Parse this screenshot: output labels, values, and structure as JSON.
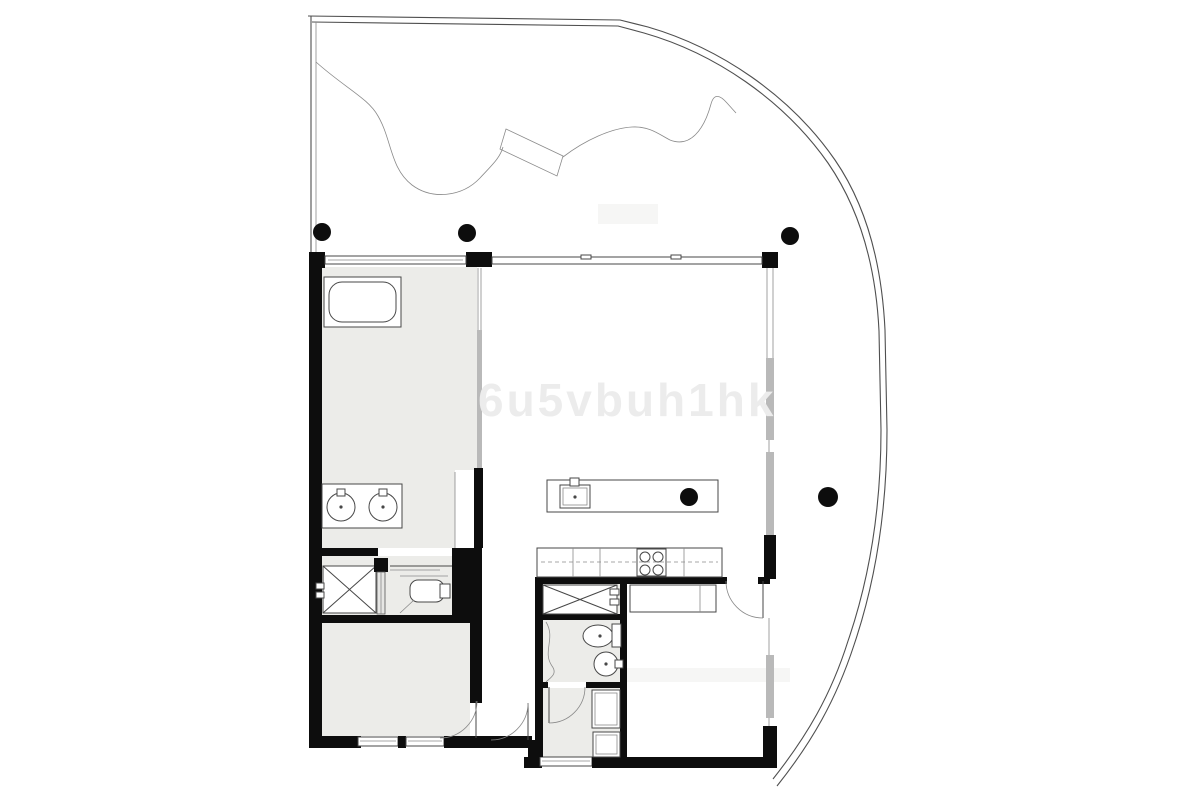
{
  "canvas": {
    "width": 1200,
    "height": 800
  },
  "palette": {
    "bg": "#ffffff",
    "wall": "#0d0d0d",
    "line": "#4f4f4f",
    "thin": "#8a8a8a",
    "floor": "#ecece9",
    "glazing": "#b9b9b9",
    "watermark": "#ececec",
    "smudge": "#f6f6f5"
  },
  "watermark": {
    "text": "6u5vbuh1hk"
  },
  "plan": {
    "type": "apartment-floor-plan-with-terrace",
    "rooms": [
      {
        "name": "terrace",
        "features": [
          "curved-perimeter",
          "garden-bed-line",
          "planter-walkway",
          "structural-columns"
        ]
      },
      {
        "name": "main-bathroom",
        "fixtures": [
          "bathtub",
          "double-vanity",
          "sink-basin",
          "sink-basin",
          "glass-partition"
        ]
      },
      {
        "name": "dressing-area",
        "fixtures": [
          "wardrobe",
          "sliding-door",
          "wc-pan"
        ]
      },
      {
        "name": "bedroom-1",
        "fixtures": [
          "door",
          "windows"
        ]
      },
      {
        "name": "entry-hall",
        "fixtures": [
          "door"
        ]
      },
      {
        "name": "living-dining",
        "fixtures": [
          "kitchen-island",
          "island-sink",
          "column"
        ]
      },
      {
        "name": "kitchen",
        "fixtures": [
          "counter",
          "cooktop",
          "dashed-worktop-line"
        ]
      },
      {
        "name": "bathroom-2",
        "fixtures": [
          "wardrobe",
          "toilet",
          "round-sink",
          "shower-curtain"
        ]
      },
      {
        "name": "laundry",
        "fixtures": [
          "washer",
          "dryer",
          "door",
          "window"
        ]
      },
      {
        "name": "bedroom-2",
        "fixtures": [
          "built-in-wardrobe",
          "door",
          "window"
        ]
      }
    ],
    "columns_count": 5,
    "door_swings_count": 4
  }
}
